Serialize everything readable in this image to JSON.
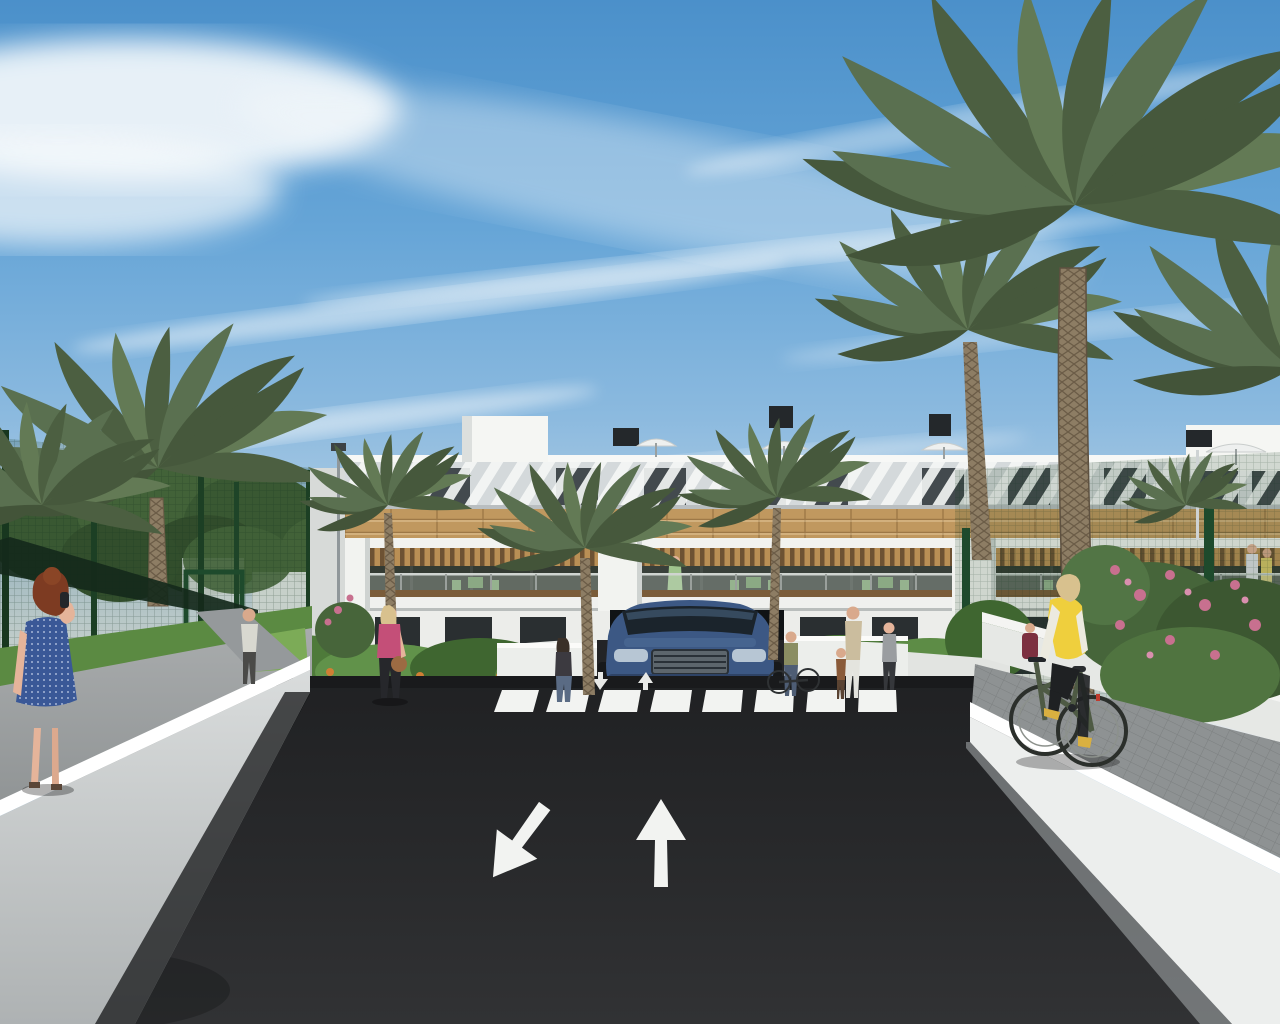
{
  "scene": {
    "type": "architectural 3D render",
    "description": "Daytime exterior rendering of a modern white Mediterranean apartment complex with palm trees, a dark asphalt access road with painted lane arrows and a zebra crosswalk, an underground parking ramp with a dark blue SUV, green padel-court fencing, gardens with pink and orange flowers, pedestrians and a cyclist",
    "time_of_day": "day",
    "weather": "sunny with wispy cirrus clouds"
  },
  "palette": {
    "sky_top": "#4b90ca",
    "sky_mid": "#8cbadf",
    "sky_horizon": "#e8eaea",
    "cloud": "#f4f8fb",
    "building_white": "#f4f5f2",
    "louver_gray": "#aab3b8",
    "window_dark": "#2e3438",
    "wood": "#c0985f",
    "pergola_shadow": "#6d5233",
    "balcony_interior": "#3a4139",
    "furniture_green": "#7da371",
    "asphalt": "#27282a",
    "road_paint": "#f2f3f1",
    "wall_lit": "#f0f1ef",
    "wall_shade": "#c7cbcb",
    "sidewalk": "#94989a",
    "grass": "#5e8c44",
    "tree_dark": "#3f5a33",
    "palm_green": "#57694a",
    "palm_trunk": "#8d7d64",
    "fence_green": "#1e4a2c",
    "flower_pink": "#c8708f",
    "flower_orange": "#c97a3d",
    "car_blue": "#3c5884",
    "vest_yellow": "#efcf3d",
    "dress_blue": "#3a5897",
    "top_pink": "#c44f78",
    "hair_red": "#7d3b22",
    "skin": "#e5b49a"
  },
  "building": {
    "style": "modern white apartment block, three levels with rooftop terraces",
    "balcony_bays": 3,
    "rooftop_parasols": 4,
    "chimneys": 4,
    "features": [
      "stepped white parapet",
      "attic band of diagonal white louvers with dark windows",
      "timber-clad band",
      "balcony bays with timber pergolas and glass railings",
      "outdoor furniture on balconies",
      "dark glazed ground-floor doors",
      "underground parking entrance"
    ]
  },
  "road": {
    "surface": "dark asphalt",
    "lane_arrows": [
      "down-left",
      "up"
    ],
    "ramp_arrows": [
      "down",
      "up"
    ],
    "crosswalk_stripes": 8
  },
  "vehicles": [
    {
      "type": "suv",
      "color": "#3c5884",
      "description": "Dark blue SUV emerging from the underground parking ramp"
    }
  ],
  "landscape": {
    "palm_count": 9,
    "fence": "dark green mesh sports-court fencing",
    "flower_colors": [
      "pink",
      "orange"
    ],
    "lawn": true
  },
  "people": [
    {
      "description": "Red-haired woman in a blue polka-dot dress holding a phone, seen from behind on the left walkway"
    },
    {
      "description": "Man in a light shirt walking away on the garden path"
    },
    {
      "description": "Blonde woman in a pink top with a brown handbag crossing toward the road"
    },
    {
      "description": "Dark-haired woman standing beside the garage ramp planter"
    },
    {
      "description": "Woman in a green dress standing on a first-floor balcony"
    },
    {
      "description": "Woman standing with a bicycle near the entrance garden"
    },
    {
      "description": "Adult holding hands with a child on the right walkway"
    },
    {
      "description": "Woman in a gray top near the entrance"
    },
    {
      "description": "Couple standing on the rightmost balcony"
    },
    {
      "description": "Blonde woman in a yellow vest riding a bicycle on the right sidewalk"
    },
    {
      "description": "Person seated at a table behind the right wall"
    }
  ]
}
